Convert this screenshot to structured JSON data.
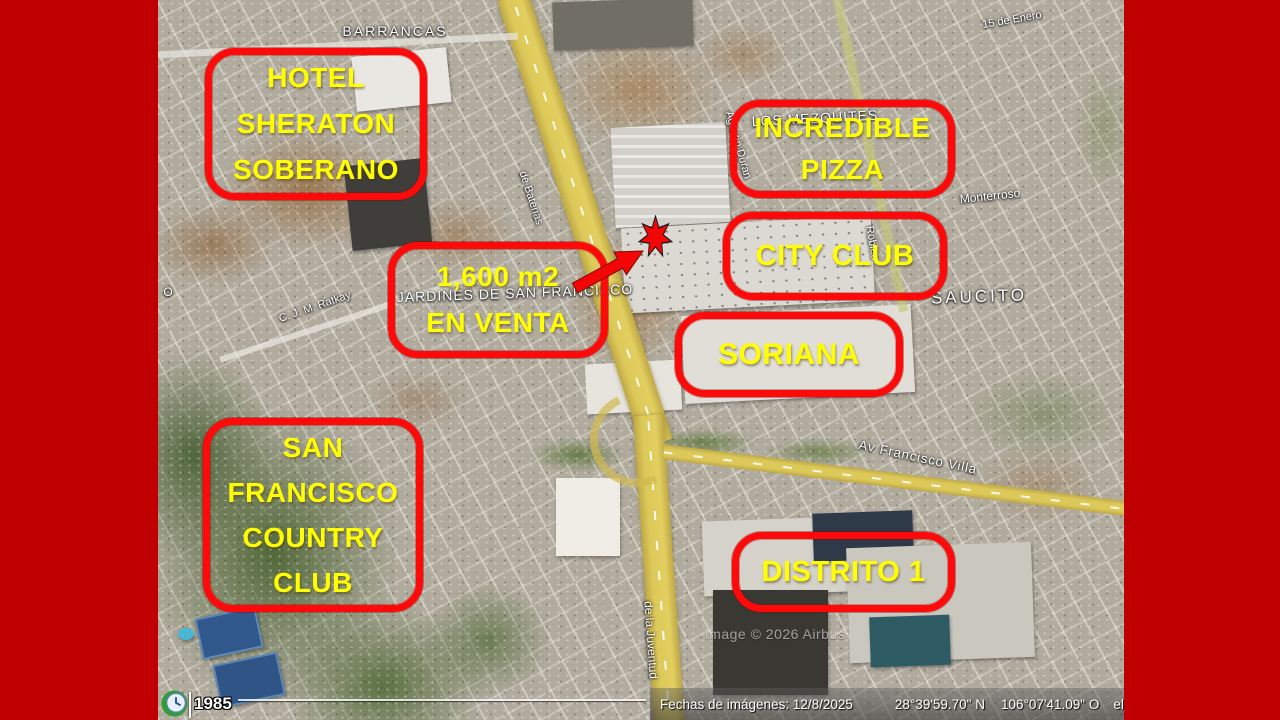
{
  "slide": {
    "background_color": "#c00000"
  },
  "map": {
    "callouts": {
      "hotel_sheraton": "HOTEL\nSHERATON\nSOBERANO",
      "incredible_pizza": "INCREDIBLE\nPIZZA",
      "city_club": "CITY CLUB",
      "lot_for_sale": "1,600 m2\nEN VENTA",
      "soriana": "SORIANA",
      "country_club": "SAN\nFRANCISCO\nCOUNTRY\nCLUB",
      "distrito_1": "DISTRITO 1"
    },
    "street_labels": {
      "barrancas": "BARRANCAS",
      "los_mezquites": "LOS MEZQUITES",
      "enero": "15 de Enero",
      "monterroso": "Monterroso",
      "saucito": "SAUCITO",
      "jardines": "JARDINES DE SAN FRANCISCO",
      "ratkay": "C. J. M. Ratkay",
      "francisco_villa": "Av Francisco Villa",
      "juventud": "de la Juventud",
      "baterias": "de Baterias",
      "duran": "Agustin Duran",
      "robles": "Robles",
      "edge_partial": "O"
    },
    "watermark": "Image © 2026 Airbus",
    "status_bar": {
      "dates": "Fechas de imágenes: 12/8/2025",
      "latitude": "28°39'59.70\" N",
      "longitude": "106°07'41.09\" O",
      "elevation_cut": "ele"
    },
    "timeline": {
      "start_year": "1985"
    },
    "colors": {
      "callout_stroke": "#ff0000",
      "callout_text": "#ffff00",
      "marker_fill": "#ff0000",
      "slide_border": "#c00000"
    }
  }
}
